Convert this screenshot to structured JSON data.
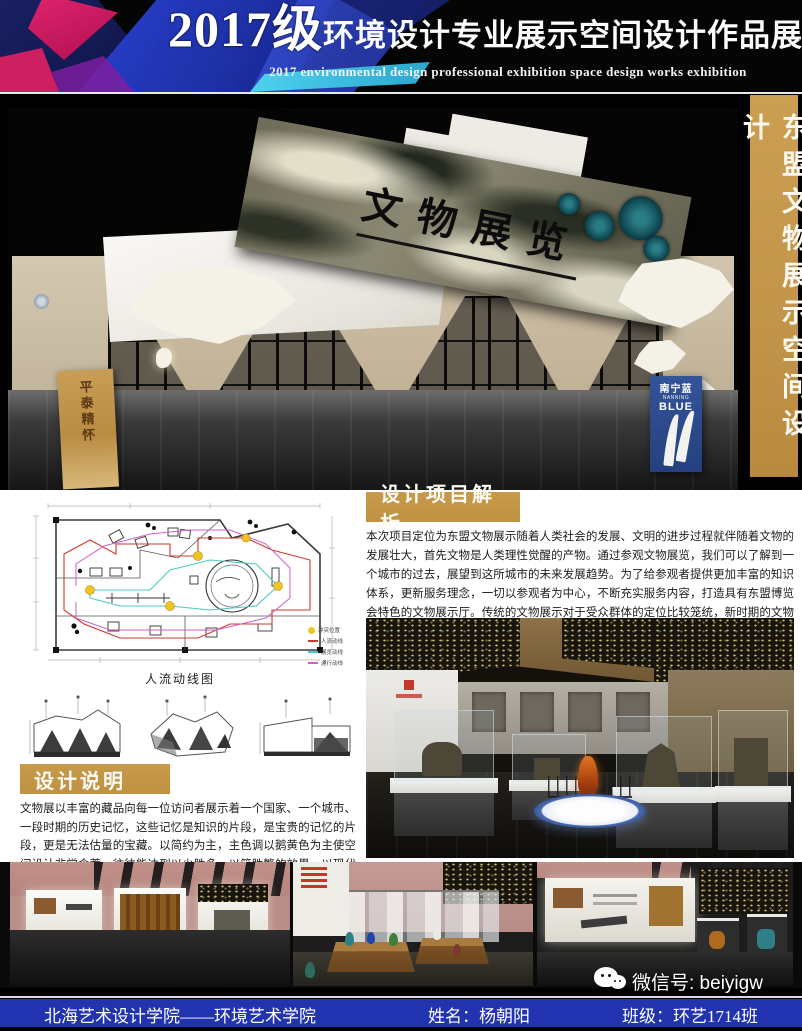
{
  "header": {
    "title_year": "2017级",
    "title_cn": "环境设计专业展示空间设计作品展",
    "subtitle_en": "2017 environmental design professional exhibition space design works exhibition"
  },
  "side_banner": {
    "text": "东盟文物展示空间设计",
    "bg_color": "#c2954a"
  },
  "hero_render": {
    "sign_text": "文物展览",
    "left_banner_text": "平泰精怀",
    "right_banner": {
      "cn": "南宁蓝",
      "en1": "NANNING",
      "en2": "BLUE"
    }
  },
  "floor_plan": {
    "caption": "人流动线图",
    "legend": [
      {
        "label": "冲突位置",
        "color": "#f0c422",
        "type": "dot"
      },
      {
        "label": "人流动线",
        "color": "#cf3a2b",
        "type": "line"
      },
      {
        "label": "展览动线",
        "color": "#4cc8c0",
        "type": "line"
      },
      {
        "label": "通行动线",
        "color": "#cf5ec9",
        "type": "line"
      }
    ]
  },
  "analysis": {
    "heading": "设计项目解析",
    "body": "本次项目定位为东盟文物展示随着人类社会的发展、文明的进步过程就伴随着文物的发展壮大，首先文物是人类理性觉醒的产物。通过参观文物展览，我们可以了解到一个城市的过去，展望到这所城市的未来发展趋势。为了给参观者提供更加丰富的知识体系，更新服务理念，一切以参观者为中心，不断充实服务内容，打造具有东盟博览会特色的文物展示厅。传统的文物展示对于受众群体的定位比较笼统，新时期的文物展示一定要做好不同观众群体的定位和分析，根据不同观众群体的特征展开针对性的个性化的服务。"
  },
  "description": {
    "heading": "设计说明",
    "body": "文物展以丰富的藏品向每一位访问者展示着一个国家、一个城市、一段时期的历史记忆，这些记忆是知识的片段，是宝贵的记忆的片段，更是无法估量的宝藏。以简约为主，主色调以鹅黄色为主使空间设计非常含蓄，往往能达到以少胜多、以简胜繁的效果。以现代简约主义风格的特色是将设计的元素、色彩、照明、原材料简化到最少的程度，但对色彩、材料的质感要求很高。"
  },
  "wechat": {
    "label": "微信号: beiyigw"
  },
  "footer": {
    "school": "北海艺术设计学院——环境艺术学院",
    "author": "姓名：杨朝阳",
    "class": "班级：环艺1714班",
    "bar_color": "#2133ae"
  },
  "colors": {
    "gold_label": "#c79a4b",
    "footer_blue": "#2133ae",
    "header_bg": "#050505",
    "marble_teal": "#2a7d85"
  }
}
